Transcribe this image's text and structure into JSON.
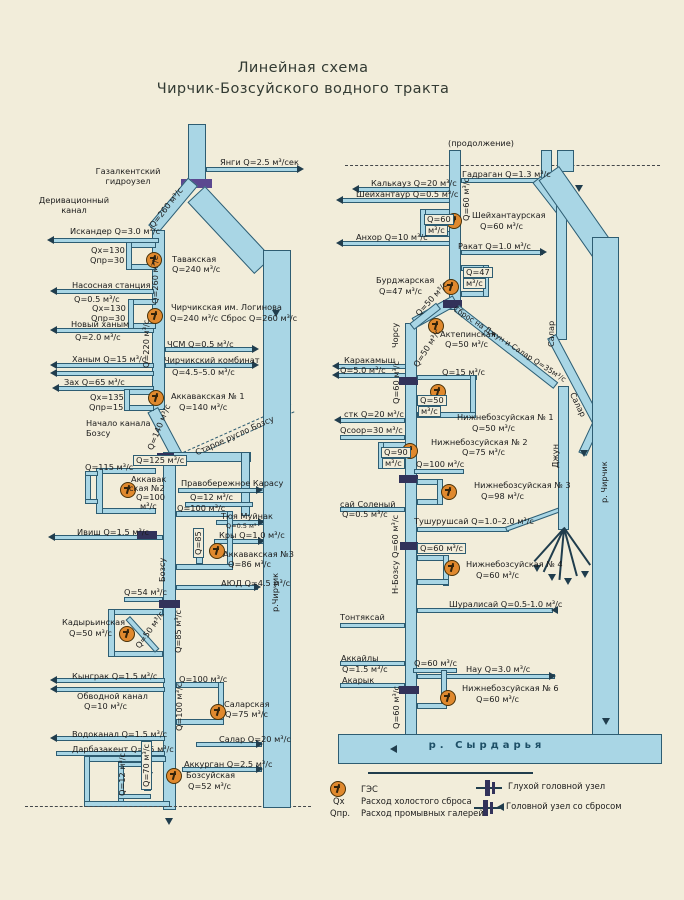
{
  "title": {
    "line1": "Линейная схема",
    "line2": "Чирчик-Бозсуйского водного тракта"
  },
  "legend": {
    "ges": "ГЭС",
    "qx_sym": "Qх",
    "qx": "Расход холостого сброса",
    "qpr_sym": "Qпр.",
    "qpr": "Расход промывных галерей",
    "blind_node": "Глухой головной узел",
    "spill_node": "Головной узел со сбросом"
  },
  "colors": {
    "paper": "#f2edda",
    "canal_fill": "#a9d6e5",
    "canal_outline": "#2e5d72",
    "ges_fill": "#e0892e",
    "node_bar": "#32325a",
    "gazalkent_bar": "#5b4890",
    "ink": "#1c1c1c",
    "river_text": "#1d4f66"
  },
  "labels": [
    {
      "t": "Янги Q=2.5 м³/сек",
      "x": 220,
      "y": 158
    },
    {
      "t": "Газалкентский",
      "cx": 128,
      "y": 167
    },
    {
      "t": "гидроузел",
      "cx": 128,
      "y": 177
    },
    {
      "t": "Деривационный",
      "cx": 74,
      "y": 196
    },
    {
      "t": "канал",
      "cx": 74,
      "y": 206
    },
    {
      "t": "Q=260 м³/с",
      "x": 148,
      "y": 224,
      "rot": -52
    },
    {
      "t": "Искандер Q=3.0 м³/с",
      "x": 70,
      "y": 227
    },
    {
      "t": "Qх=130",
      "x": 91,
      "y": 246
    },
    {
      "t": "Qпр=30",
      "x": 90,
      "y": 256
    },
    {
      "t": "Тавакская",
      "x": 172,
      "y": 255
    },
    {
      "t": "Q=240 м³/с",
      "x": 172,
      "y": 265
    },
    {
      "t": "Q=260 м³/с",
      "x": 151,
      "y": 304,
      "rot": -90
    },
    {
      "t": "Насосная станция",
      "x": 72,
      "y": 281
    },
    {
      "t": "Q=0.5 м³/с",
      "x": 74,
      "y": 295
    },
    {
      "t": "Qх=130",
      "x": 92,
      "y": 304
    },
    {
      "t": "Qпр=30",
      "x": 91,
      "y": 314
    },
    {
      "t": "Чирчикская им. Логинова",
      "x": 171,
      "y": 303
    },
    {
      "t": "Q=240 м³/с Сброс Q=260 м³/с",
      "x": 170,
      "y": 314
    },
    {
      "t": "Новый ханым",
      "x": 71,
      "y": 320
    },
    {
      "t": "Q=2.0 м³/с",
      "x": 75,
      "y": 333
    },
    {
      "t": "Q=220 м³/с",
      "x": 142,
      "y": 368,
      "rot": -90
    },
    {
      "t": "ЧСМ Q=0.5 м³/с",
      "x": 167,
      "y": 340
    },
    {
      "t": "Чирчикский комбинат",
      "x": 164,
      "y": 356
    },
    {
      "t": "Q=4.5–5.0 м³/с",
      "x": 172,
      "y": 368
    },
    {
      "t": "Ханым Q=15 м³/с",
      "x": 72,
      "y": 355
    },
    {
      "t": "Зах Q=65 м³/с",
      "x": 64,
      "y": 378
    },
    {
      "t": "Qх=135",
      "x": 90,
      "y": 393
    },
    {
      "t": "Qпр=15",
      "x": 89,
      "y": 403
    },
    {
      "t": "Аккавакская № 1",
      "x": 171,
      "y": 392
    },
    {
      "t": "Q=140 м³/с",
      "x": 179,
      "y": 403
    },
    {
      "t": "Начало канала",
      "x": 86,
      "y": 419
    },
    {
      "t": "Бозсу",
      "x": 86,
      "y": 429
    },
    {
      "t": "Q=140 м³/с",
      "x": 146,
      "y": 448,
      "rot": -68
    },
    {
      "t": "Старое русло Бозсу",
      "x": 194,
      "y": 449,
      "rot": -24
    },
    {
      "t": "Q=125 м³/с",
      "x": 133,
      "y": 455,
      "cls": "box"
    },
    {
      "t": "Q=115 м³/с",
      "x": 85,
      "y": 463
    },
    {
      "t": "Аккавак",
      "x": 131,
      "y": 475
    },
    {
      "t": "ская №2",
      "x": 129,
      "y": 484
    },
    {
      "t": "Q=100",
      "x": 136,
      "y": 493
    },
    {
      "t": "м³/с",
      "x": 140,
      "y": 502
    },
    {
      "t": "Правобережное Карасу",
      "x": 181,
      "y": 479
    },
    {
      "t": "Q=12 м³/с",
      "x": 190,
      "y": 493
    },
    {
      "t": "Q=100 м³/с",
      "x": 177,
      "y": 504
    },
    {
      "t": "Тюя Муйнак",
      "x": 221,
      "y": 512
    },
    {
      "t": "Q=0.5 м³",
      "x": 226,
      "y": 523,
      "fs": 6.5
    },
    {
      "t": "Ивиш Q=1.5 м³/с",
      "x": 77,
      "y": 528
    },
    {
      "t": "Кры Q=1.0 м³/с",
      "x": 219,
      "y": 531
    },
    {
      "t": "Q=85",
      "x": 193,
      "y": 558,
      "rot": -90,
      "cls": "box"
    },
    {
      "t": "Аккавакская №3",
      "x": 223,
      "y": 550
    },
    {
      "t": "Q=86 м³/с",
      "x": 228,
      "y": 560
    },
    {
      "t": "АЮД Q=4.5 м³/с",
      "x": 221,
      "y": 579
    },
    {
      "t": "Бозсу",
      "x": 158,
      "y": 582,
      "rot": -90
    },
    {
      "t": "Q=54 м³/с",
      "x": 124,
      "y": 588
    },
    {
      "t": "Кадырьинская",
      "x": 62,
      "y": 618
    },
    {
      "t": "Q=50 м³/с",
      "x": 69,
      "y": 629
    },
    {
      "t": "Q=50 м³/с",
      "x": 134,
      "y": 645,
      "rot": -55
    },
    {
      "t": "Q=85 м³/с",
      "x": 174,
      "y": 653,
      "rot": -90
    },
    {
      "t": "Кынграк Q=1.5 м³/с",
      "x": 72,
      "y": 672
    },
    {
      "t": "Q=100 м³/с",
      "x": 179,
      "y": 675
    },
    {
      "t": "Обводной канал",
      "x": 77,
      "y": 692
    },
    {
      "t": "Q=10 м³/с",
      "x": 84,
      "y": 702
    },
    {
      "t": "Q=100 м³/с",
      "x": 175,
      "y": 731,
      "rot": -90
    },
    {
      "t": "Саларская",
      "x": 224,
      "y": 700
    },
    {
      "t": "Q=75 м³/с",
      "x": 225,
      "y": 710
    },
    {
      "t": "Водоканал Q=1.5 м³/с",
      "x": 72,
      "y": 730
    },
    {
      "t": "Салар Q=20 м³/с",
      "x": 219,
      "y": 735
    },
    {
      "t": "Дарбазакент  Q=25 м³/с",
      "x": 72,
      "y": 745
    },
    {
      "t": "Аккурган Q=2.5 м³/с",
      "x": 184,
      "y": 760
    },
    {
      "t": "Q=12 м³/с",
      "x": 118,
      "y": 796,
      "rot": -90
    },
    {
      "t": "Q=70 м³/с",
      "x": 141,
      "y": 790,
      "rot": -90,
      "cls": "box"
    },
    {
      "t": "Бозсуйская",
      "x": 186,
      "y": 771
    },
    {
      "t": "Q=52 м³/с",
      "x": 188,
      "y": 782
    },
    {
      "t": "р.Чирчик",
      "x": 271,
      "y": 612,
      "rot": -90
    },
    {
      "t": "(продолжение)",
      "x": 448,
      "y": 139
    },
    {
      "t": "Гадраган Q=1.3 м³/с",
      "x": 462,
      "y": 170
    },
    {
      "t": "Калькауз Q=20 м³/с",
      "x": 371,
      "y": 179
    },
    {
      "t": "Шейхантаур Q=0.5 м³/с",
      "x": 356,
      "y": 190
    },
    {
      "t": "Q=60 м³/с",
      "x": 462,
      "y": 221,
      "rot": -90
    },
    {
      "t": "Q=60",
      "x": 424,
      "y": 214,
      "cls": "box"
    },
    {
      "t": "м³/с",
      "x": 425,
      "y": 225,
      "cls": "box"
    },
    {
      "t": "Шейхантаурская",
      "x": 472,
      "y": 211
    },
    {
      "t": "Q=60 м³/с",
      "x": 480,
      "y": 222
    },
    {
      "t": "Анхор Q=10 м³/с",
      "x": 356,
      "y": 233
    },
    {
      "t": "Ракат Q=1.0 м³/с",
      "x": 458,
      "y": 242
    },
    {
      "t": "Q=47",
      "x": 463,
      "y": 267,
      "cls": "box"
    },
    {
      "t": "м³/с",
      "x": 463,
      "y": 278,
      "cls": "box"
    },
    {
      "t": "Бурджарская",
      "x": 376,
      "y": 276
    },
    {
      "t": "Q=47 м³/с",
      "x": 379,
      "y": 287
    },
    {
      "t": "Q=50 м³/с",
      "x": 414,
      "y": 312,
      "rot": -48
    },
    {
      "t": "Чорсу",
      "x": 391,
      "y": 348,
      "rot": -90
    },
    {
      "t": "Актепинская",
      "x": 440,
      "y": 330
    },
    {
      "t": "Q=50 м³/с",
      "x": 445,
      "y": 340
    },
    {
      "t": "Q=50 м³/с",
      "x": 412,
      "y": 364,
      "rot": -58
    },
    {
      "t": "Сброс на Джун и Салар Q=35м³/с",
      "x": 456,
      "y": 305,
      "rot": 33,
      "fs": 7.5
    },
    {
      "t": "Каракамыш",
      "x": 344,
      "y": 356
    },
    {
      "t": "Q=5.0 м³/с",
      "x": 340,
      "y": 366
    },
    {
      "t": "Q=60 м³/с",
      "x": 392,
      "y": 404,
      "rot": -90
    },
    {
      "t": "Q=15 м³/с",
      "x": 442,
      "y": 368
    },
    {
      "t": "Q=50",
      "x": 417,
      "y": 395,
      "cls": "box"
    },
    {
      "t": "м³/с",
      "x": 418,
      "y": 406,
      "cls": "box"
    },
    {
      "t": "Нижнебозсуйская № 1",
      "x": 457,
      "y": 413
    },
    {
      "t": "Q=50 м³/с",
      "x": 472,
      "y": 424
    },
    {
      "t": "стк Q=20 м³/с",
      "x": 344,
      "y": 410
    },
    {
      "t": "Qсоор=30 м³/с",
      "x": 340,
      "y": 426
    },
    {
      "t": "Нижнебозсуйская № 2",
      "x": 431,
      "y": 438
    },
    {
      "t": "Q=75 м³/с",
      "x": 462,
      "y": 448
    },
    {
      "t": "Q=90",
      "x": 381,
      "y": 447,
      "cls": "box"
    },
    {
      "t": "м³/с",
      "x": 382,
      "y": 458,
      "cls": "box"
    },
    {
      "t": "Q=100 м³/с",
      "x": 416,
      "y": 460
    },
    {
      "t": "Нижнебозсуйская № 3",
      "x": 474,
      "y": 481
    },
    {
      "t": "Q=98 м³/с",
      "x": 481,
      "y": 492
    },
    {
      "t": "сай Соленый",
      "x": 340,
      "y": 500
    },
    {
      "t": "Q=0.5 м³/с",
      "x": 342,
      "y": 510
    },
    {
      "t": "Тушурушсай Q=1.0–2.0 м³/с",
      "x": 414,
      "y": 517
    },
    {
      "t": "Н-Бозсу Q=60 м³/с",
      "x": 391,
      "y": 594,
      "rot": -90
    },
    {
      "t": "Q=60 м³/с",
      "x": 417,
      "y": 543,
      "cls": "box"
    },
    {
      "t": "Нижнебозсуйская № 4",
      "x": 466,
      "y": 560
    },
    {
      "t": "Q=60 м³/с",
      "x": 476,
      "y": 571
    },
    {
      "t": "Шуралисай Q=0.5-1.0 м³/с",
      "x": 449,
      "y": 600
    },
    {
      "t": "Тонтяксай",
      "x": 340,
      "y": 613
    },
    {
      "t": "Аккайлы",
      "x": 341,
      "y": 654
    },
    {
      "t": "Q=1.5 м³/с",
      "x": 342,
      "y": 665
    },
    {
      "t": "Акарык",
      "x": 342,
      "y": 676
    },
    {
      "t": "Q=60 м³/с",
      "x": 414,
      "y": 659
    },
    {
      "t": "Нау Q=3.0 м³/с",
      "x": 466,
      "y": 665
    },
    {
      "t": "Нижнебозсуйская № 6",
      "x": 462,
      "y": 684
    },
    {
      "t": "Q=60 м³/с",
      "x": 476,
      "y": 695
    },
    {
      "t": "Q=60 м³/с",
      "x": 392,
      "y": 729,
      "rot": -90
    },
    {
      "t": "Салар",
      "x": 547,
      "y": 347,
      "rot": -90
    },
    {
      "t": "Салар",
      "x": 576,
      "y": 391,
      "rot": 64
    },
    {
      "t": "Джун",
      "x": 551,
      "y": 468,
      "rot": -90
    },
    {
      "t": "р. Чирчик",
      "x": 600,
      "y": 503,
      "rot": -90
    },
    {
      "t": "р. Сырдарья",
      "cx": 487,
      "y": 741,
      "fs": 10,
      "cls": "river-name"
    }
  ]
}
